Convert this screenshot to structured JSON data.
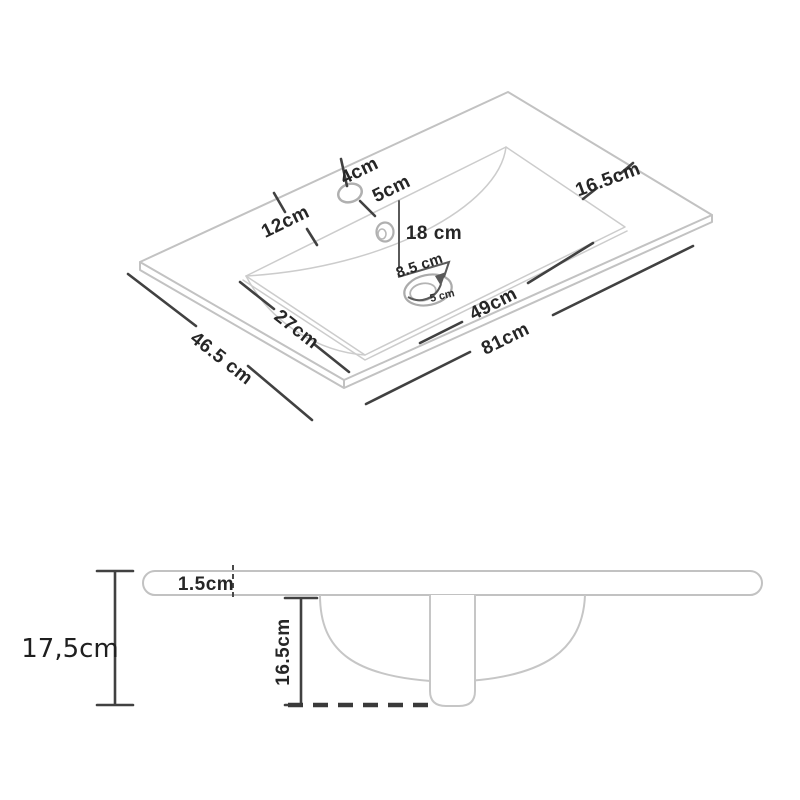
{
  "colors": {
    "background": "#ffffff",
    "object_outline": "#c2c2c2",
    "dimension_line": "#414141",
    "label_text": "#262626"
  },
  "top_view": {
    "labels": {
      "faucet_hole_diameter": "4cm",
      "faucet_offset": "5cm",
      "left_deck_width": "12cm",
      "faucet_to_drain": "18 cm",
      "drain_flange_diameter": "8.5 cm",
      "drain_hole_diameter": "5 cm",
      "basin_width": "27cm",
      "basin_length": "49cm",
      "overall_length": "81cm",
      "overall_depth": "46.5 cm",
      "right_deck_width": "16.5cm"
    }
  },
  "side_view": {
    "labels": {
      "countertop_thickness": "1.5cm",
      "basin_depth": "16.5cm",
      "overall_height": "17,5cm"
    }
  }
}
